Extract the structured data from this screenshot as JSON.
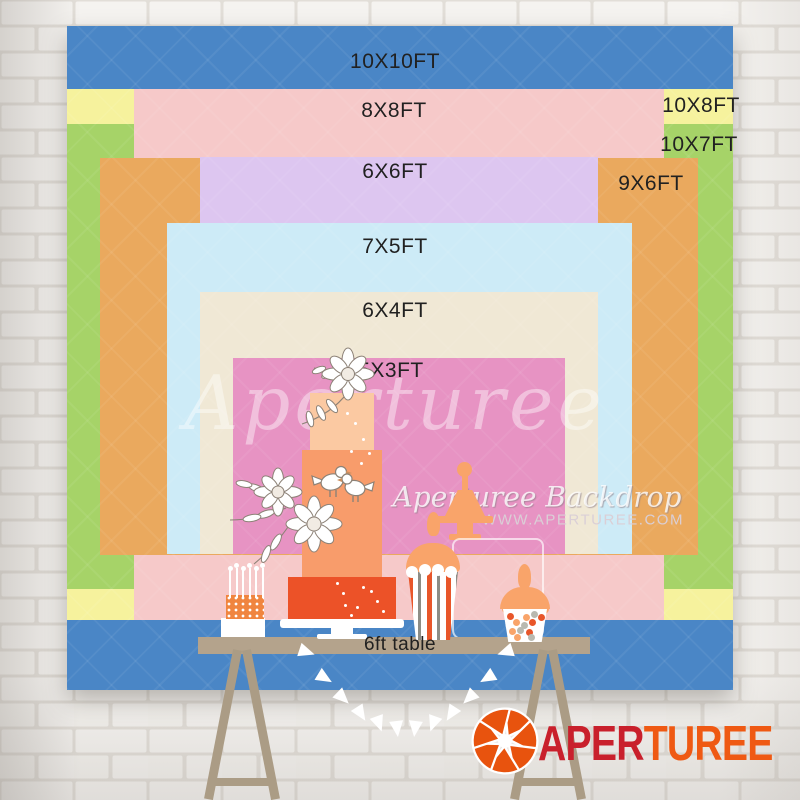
{
  "page": {
    "type": "backdrop-size-comparison-chart"
  },
  "colors": {
    "blue": "#4a86c6",
    "yellow": "#f6f29d",
    "green": "#a6d368",
    "pink": "#f6c9c9",
    "orange": "#eaa95e",
    "purple": "#ddc6f0",
    "lightblue": "#cdebf7",
    "beige": "#f0e8d5",
    "magenta": "#e793c3",
    "label": "#212121",
    "tabletan": "#b4a38c",
    "leg": "#ab9c85",
    "logo_red": "#c9202c",
    "logo_orange": "#ef5913",
    "cake_top": "#fbc9a2",
    "cake_mid": "#f89c6b",
    "cake_bottom": "#ec5228",
    "peach": "#f9a46a",
    "stripe_orange": "#e8562a",
    "stripe_gray": "#8d8d86",
    "brick": "#f5f3f0",
    "mortar": "#e2ded8",
    "watermark": "#dacfd6"
  },
  "sizes": [
    {
      "label": "10X10FT",
      "color": "#4a86c6"
    },
    {
      "label": "10X8FT",
      "color": "#f6f29d"
    },
    {
      "label": "10X7FT",
      "color": "#a6d368"
    },
    {
      "label": "8X8FT",
      "color": "#f6c9c9"
    },
    {
      "label": "9X6FT",
      "color": "#eaa95e"
    },
    {
      "label": "6X6FT",
      "color": "#ddc6f0"
    },
    {
      "label": "7X5FT",
      "color": "#cdebf7"
    },
    {
      "label": "6X4FT",
      "color": "#f0e8d5"
    },
    {
      "label": "5X3FT",
      "color": "#e793c3"
    }
  ],
  "table": {
    "label": "6ft table"
  },
  "watermarks": {
    "center_script": "Aperturee",
    "brand_script": "Aperturee Backdrop",
    "site": "WWW.APERTUREE.COM"
  },
  "logo": {
    "text_primary": "APER",
    "text_secondary": "TUREE"
  },
  "decor": {
    "pennant_count": 12,
    "cakepop_sticks": 6,
    "candy_count": 16
  }
}
